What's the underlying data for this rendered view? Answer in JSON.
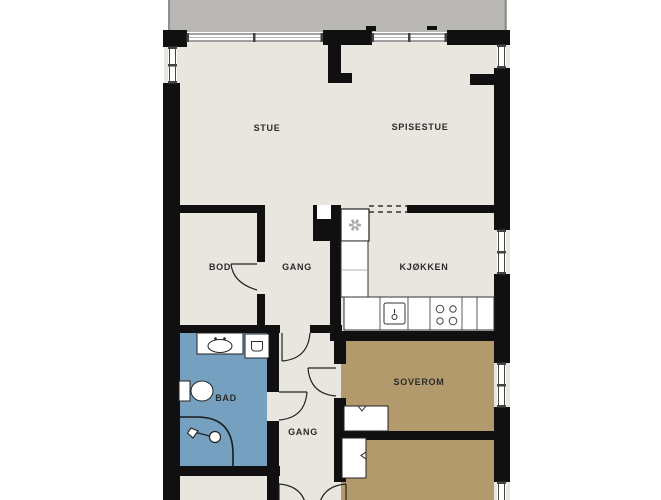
{
  "title": "Apartment floor plan",
  "colors": {
    "wall": "#101010",
    "floor": "#e9e6e0",
    "balcony": "#b9b8b5",
    "balcony-edge": "#8f8f8d",
    "bathroom": "#75a0c0",
    "bedroom": "#b29a6c",
    "fixture-line": "#2a2a2a",
    "window-line": "#444444"
  },
  "rooms": {
    "stue": {
      "label": "STUE"
    },
    "spisestue": {
      "label": "SPISESTUE"
    },
    "bod": {
      "label": "BOD"
    },
    "gang_upper": {
      "label": "GANG"
    },
    "kjokken": {
      "label": "KJØKKEN"
    },
    "bad": {
      "label": "BAD"
    },
    "soverom": {
      "label": "SOVEROM"
    },
    "gang_lower": {
      "label": "GANG"
    }
  },
  "fixtures": [
    "balcony",
    "window-band",
    "kitchen-counter",
    "kitchen-sink",
    "stove",
    "ventilation-fan",
    "chimney",
    "kitchen-opening-dashed",
    "wardrobe-soverom",
    "wardrobe-second-bedroom",
    "bathroom-sink",
    "washing-machine",
    "toilet",
    "shower",
    "interior-doors"
  ]
}
